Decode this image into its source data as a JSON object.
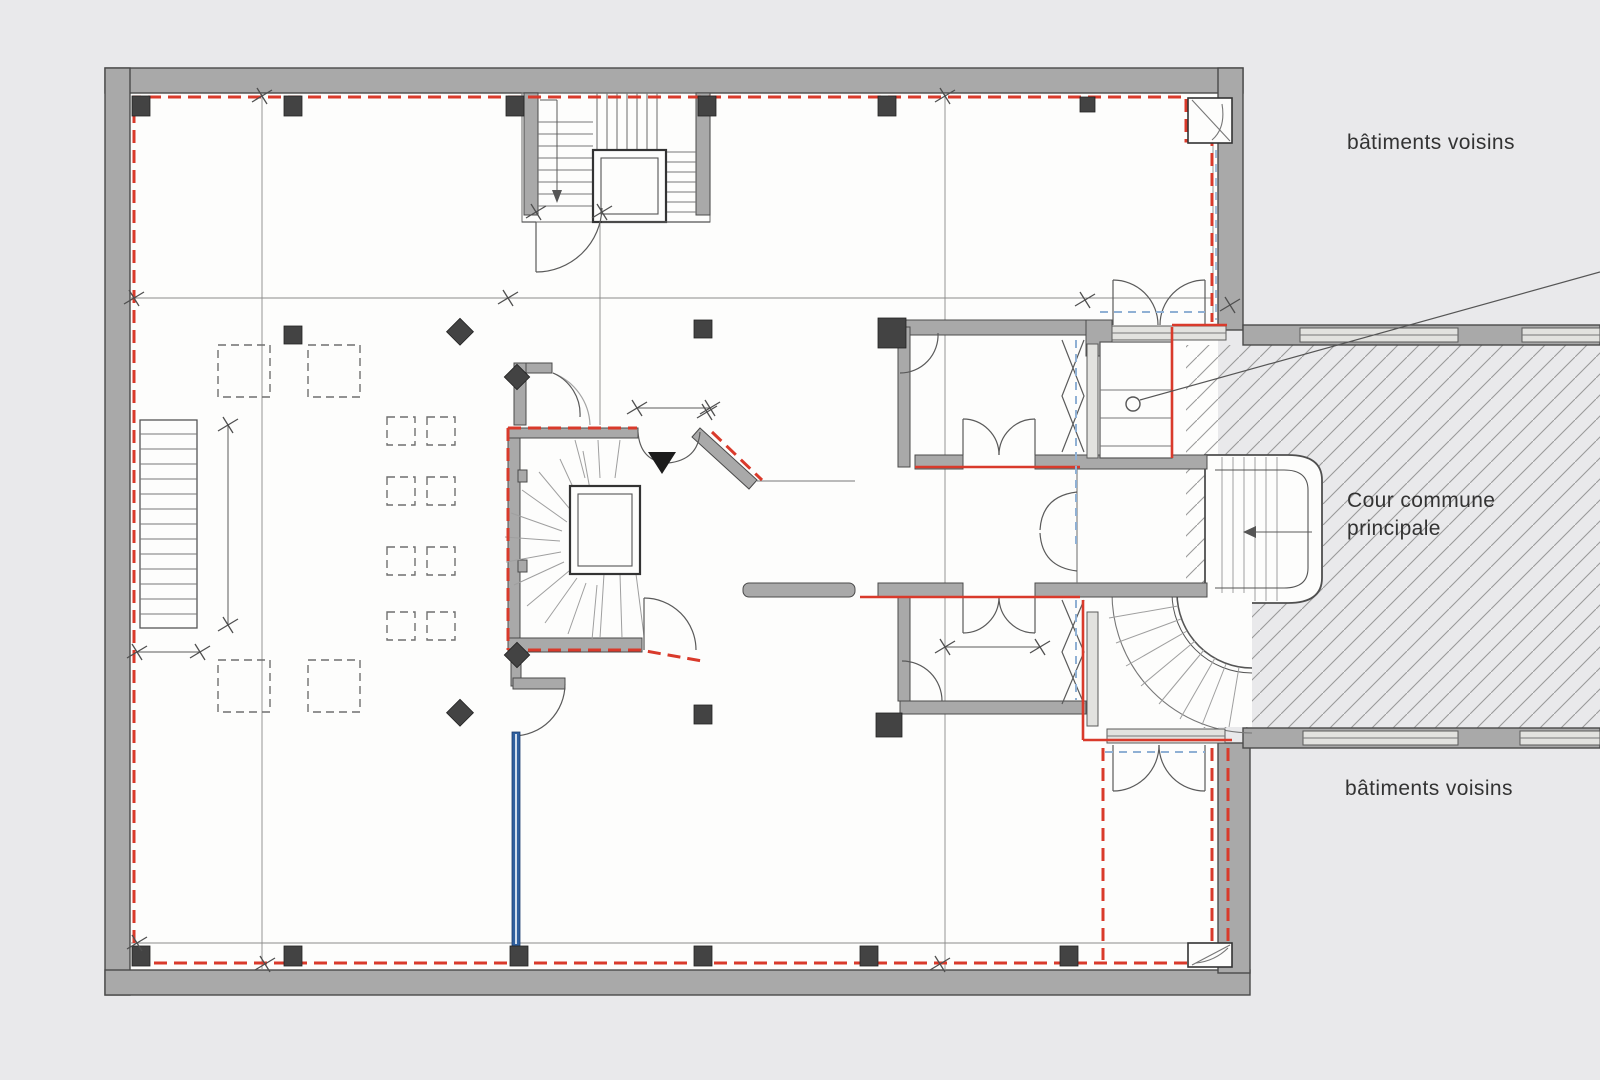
{
  "labels": {
    "neighbors_top": "bâtiments voisins",
    "neighbors_bottom": "bâtiments voisins",
    "courtyard_line1": "Cour commune",
    "courtyard_line2": "principale"
  },
  "colors": {
    "page_bg": "#e9e9eb",
    "floor": "#fdfdfc",
    "wall_fill": "#a9a9a9",
    "wall_edge": "#4a4a4a",
    "line_thin": "#777777",
    "hatch": "#9a9a9a",
    "column": "#434343",
    "demolition_red": "#d93a2b",
    "plumbing_blue": "#30609f",
    "guide_blue": "#8fb0d4",
    "label_text": "#333333"
  }
}
